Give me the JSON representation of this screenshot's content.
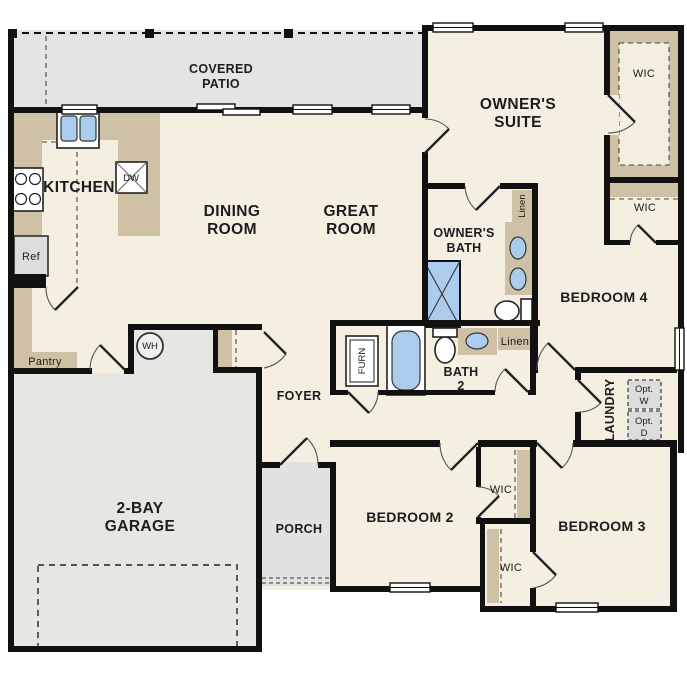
{
  "colors": {
    "wall": "#111111",
    "floor": "#f5efe2",
    "hard_surface": "#e6e6e3",
    "cabinetry": "#cfc1a5",
    "plumbing_fixture": "#abccec",
    "appliance_optional": "#dcdcdc",
    "text": "#1c1c1c"
  },
  "rooms": {
    "covered_patio": {
      "line1": "COVERED",
      "line2": "PATIO"
    },
    "owners_suite": {
      "line1": "OWNER'S",
      "line2": "SUITE"
    },
    "dining_room": {
      "line1": "DINING",
      "line2": "ROOM"
    },
    "great_room": {
      "line1": "GREAT",
      "line2": "ROOM"
    },
    "kitchen": {
      "label": "KITCHEN"
    },
    "owners_bath": {
      "line1": "OWNER'S",
      "line2": "BATH"
    },
    "bath_2": {
      "line1": "BATH",
      "line2": "2"
    },
    "bedroom_2": {
      "label": "BEDROOM 2"
    },
    "bedroom_3": {
      "label": "BEDROOM 3"
    },
    "bedroom_4": {
      "label": "BEDROOM 4"
    },
    "garage": {
      "line1": "2-BAY",
      "line2": "GARAGE"
    },
    "foyer": {
      "label": "FOYER"
    },
    "porch": {
      "label": "PORCH"
    },
    "laundry": {
      "label": "LAUNDRY"
    },
    "pantry": {
      "label": "Pantry"
    },
    "wic_owners_suite": {
      "label": "WIC"
    },
    "wic_bedroom_4": {
      "label": "WIC"
    },
    "wic_bedroom_2": {
      "label": "WIC"
    },
    "wic_bedroom_3": {
      "label": "WIC"
    },
    "linen_owners_bath": {
      "label": "Linen"
    },
    "linen_hall": {
      "label": "Linen"
    }
  },
  "fixtures": {
    "refrigerator": {
      "label": "Ref"
    },
    "dishwasher": {
      "label": "DW"
    },
    "water_heater": {
      "label": "WH"
    },
    "furnace": {
      "label": "FURN"
    },
    "optional_washer": {
      "line1": "Opt.",
      "line2": "W"
    },
    "optional_dryer": {
      "line1": "Opt.",
      "line2": "D"
    }
  }
}
